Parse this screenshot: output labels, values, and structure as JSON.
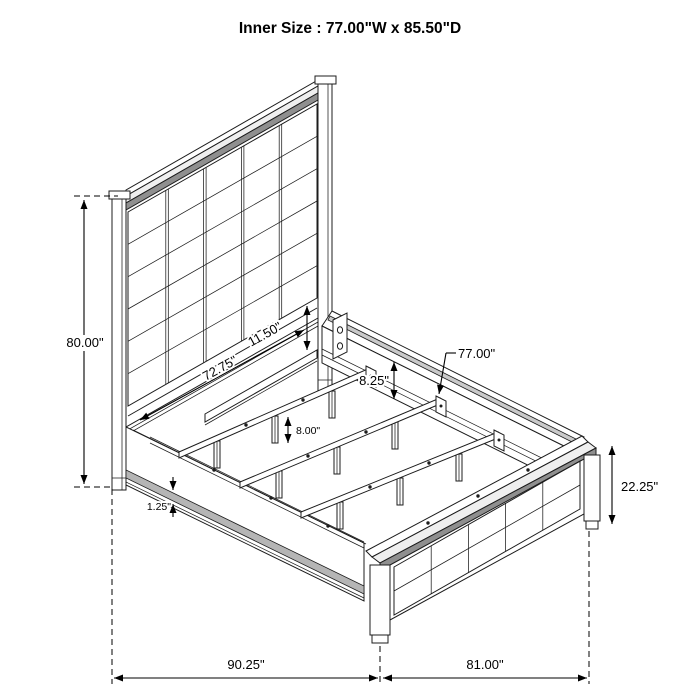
{
  "title": "Inner Size : 77.00\"W x 85.50\"D",
  "dimensions": {
    "headboard_height": "80.00\"",
    "headboard_panel_width": "72.75\"",
    "headboard_bottom_gap": "11.50\"",
    "side_rail_height": "8.25\"",
    "slat_leg_height": "8.00\"",
    "slat_length": "77.00\"",
    "rail_trim_thickness": "1.25\"",
    "footboard_height": "22.25\"",
    "overall_depth": "90.25\"",
    "overall_width": "81.00\""
  },
  "colors": {
    "line": "#1c1c1c",
    "dimension": "#000000",
    "shade_dark": "#8f8f8f",
    "shade_mid": "#c9c9c9",
    "shade_light": "#efefef",
    "trim": "#b5b5b5",
    "background": "#ffffff"
  }
}
